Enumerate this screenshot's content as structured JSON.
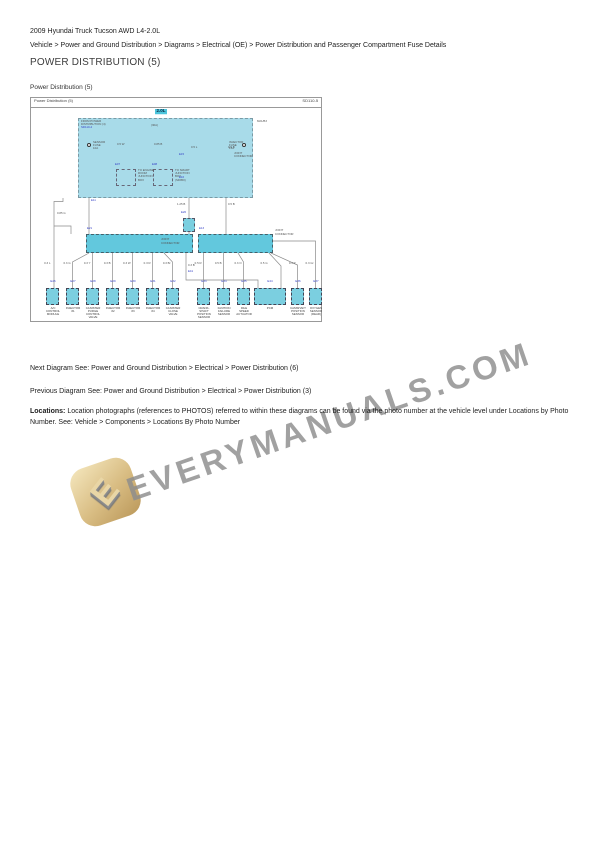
{
  "page": {
    "vehicle_title": "2009 Hyundai Truck Tucson AWD L4-2.0L",
    "breadcrumb": "Vehicle > Power and Ground Distribution > Diagrams > Electrical (OE) > Power Distribution and Passenger Compartment Fuse Details",
    "heading": "POWER DISTRIBUTION (5)",
    "diagram_caption": "Power Distribution (5)",
    "next_diagram": "Next Diagram See: Power and Ground Distribution > Electrical > Power Distribution (6)",
    "previous_diagram": "Previous Diagram See: Power and Ground Distribution > Electrical > Power Distribution (3)",
    "locations_label": "Locations:",
    "locations_text": " Location photographs (references to PHOTOS) referred to within these diagrams can be found via the photo number at the vehicle level under Locations by Photo Number. See: Vehicle > Components > Locations By Photo Number"
  },
  "watermark": {
    "text": "EVERYMANUALS.COM",
    "logo_letter": "E"
  },
  "colors": {
    "diagram_box_fill": "#a8dbe9",
    "joint_connector_fill": "#62c8dd",
    "engine_tag_fill": "#4cc5dc",
    "blue_label": "#3540c6",
    "wire_gray": "#8a8a8a",
    "watermark_gray": "#8d8d8d",
    "logo_tan": "#d8bc82"
  },
  "diagram": {
    "title": "Power Distribution (5)",
    "code": "SD110-5",
    "engine_tag": "2.0L",
    "labels": [
      {
        "x": 50,
        "y": 22,
        "t": "FROM POWER"
      },
      {
        "x": 50,
        "y": 25.2,
        "t": "DISTRIBUTION (4)"
      },
      {
        "x": 50,
        "y": 28.4,
        "t": "SD110-4",
        "c": "b"
      },
      {
        "x": 120,
        "y": 25.5,
        "t": "(30A)"
      },
      {
        "x": 226,
        "y": 22,
        "t": "M21/B3"
      },
      {
        "x": 62,
        "y": 43,
        "t": "SENSOR"
      },
      {
        "x": 62,
        "y": 46.2,
        "t": "FUSE"
      },
      {
        "x": 62,
        "y": 49.4,
        "t": "10A"
      },
      {
        "x": 198,
        "y": 43,
        "t": "INJECTOR"
      },
      {
        "x": 198,
        "y": 46.2,
        "t": "FUSE"
      },
      {
        "x": 198,
        "y": 49.4,
        "t": "15A"
      },
      {
        "x": 86,
        "y": 45,
        "t": "0.5 W"
      },
      {
        "x": 123,
        "y": 45,
        "t": "0.85 B"
      },
      {
        "x": 84,
        "y": 65,
        "t": "E07",
        "c": "b"
      },
      {
        "x": 121,
        "y": 65,
        "t": "E08",
        "c": "b"
      },
      {
        "x": 107,
        "y": 71,
        "t": "TO ENGINE"
      },
      {
        "x": 107,
        "y": 74.2,
        "t": "ROOM"
      },
      {
        "x": 107,
        "y": 77.4,
        "t": "JUNCTION"
      },
      {
        "x": 107,
        "y": 80.6,
        "t": "BOX"
      },
      {
        "x": 144,
        "y": 71,
        "t": "TO SMART"
      },
      {
        "x": 144,
        "y": 74.2,
        "t": "JUNCTION"
      },
      {
        "x": 144,
        "y": 77.4,
        "t": "BOX"
      },
      {
        "x": 144,
        "y": 80.6,
        "t": "(SD950)"
      },
      {
        "x": 148,
        "y": 55,
        "t": "E15",
        "c": "b"
      },
      {
        "x": 148,
        "y": 77.5,
        "t": "E16",
        "c": "b"
      },
      {
        "x": 160,
        "y": 48,
        "t": "0.5 L"
      },
      {
        "x": 197,
        "y": 48,
        "t": "0.5 B"
      },
      {
        "x": 203,
        "y": 54,
        "t": "JOINT"
      },
      {
        "x": 203,
        "y": 57.2,
        "t": "CONNECTOR"
      },
      {
        "x": 60,
        "y": 101,
        "t": "E11",
        "c": "b"
      },
      {
        "x": 26,
        "y": 114,
        "t": "0.85 G"
      },
      {
        "x": 146,
        "y": 105,
        "t": "1.25 B"
      },
      {
        "x": 197,
        "y": 105,
        "t": "0.5 B"
      },
      {
        "x": 150,
        "y": 113,
        "t": "E20",
        "c": "b"
      },
      {
        "x": 56,
        "y": 129,
        "t": "E21",
        "c": "b"
      },
      {
        "x": 168,
        "y": 129,
        "t": "E13",
        "c": "b"
      },
      {
        "x": 130,
        "y": 140,
        "t": "JOINT"
      },
      {
        "x": 130,
        "y": 143.5,
        "t": "CONNECTOR"
      },
      {
        "x": 244,
        "y": 131,
        "t": "JOINT"
      },
      {
        "x": 244,
        "y": 134.5,
        "t": "CONNECTOR"
      },
      {
        "x": 157,
        "y": 166,
        "t": "0.3 B"
      },
      {
        "x": 157,
        "y": 172,
        "t": "E41",
        "c": "b"
      }
    ],
    "components": [
      {
        "cx": 21.5,
        "hx": -6.5,
        "w": 13,
        "wire": "0.3 L",
        "code": "E26",
        "caption": "A/C\nCONTROL\nMODULE"
      },
      {
        "cx": 41.5,
        "hx": -6.5,
        "w": 13,
        "wire": "0.3 G",
        "code": "E27",
        "caption": "INJECTOR\n#1"
      },
      {
        "cx": 61.5,
        "hx": -6.5,
        "w": 13,
        "wire": "0.3 Y",
        "code": "E28",
        "caption": "CANISTER\nPURGE\nCONTROL\nVALVE"
      },
      {
        "cx": 81.5,
        "hx": -6.5,
        "w": 13,
        "wire": "0.3 B",
        "code": "E29",
        "caption": "INJECTOR\n#2"
      },
      {
        "cx": 101.5,
        "hx": -6.5,
        "w": 13,
        "wire": "0.3 W",
        "code": "E30",
        "caption": "INJECTOR\n#3"
      },
      {
        "cx": 121.5,
        "hx": -6.5,
        "w": 13,
        "wire": "0.3 R",
        "code": "E31",
        "caption": "INJECTOR\n#4"
      },
      {
        "cx": 141.5,
        "hx": -6.5,
        "w": 13,
        "wire": "0.3 Br",
        "code": "E32",
        "caption": "CANISTER\nCLOSE\nVALVE"
      },
      {
        "cx": 172.5,
        "hx": -6.5,
        "w": 13,
        "wire": "0.5 R",
        "code": "E33",
        "caption": "CRANK-\nSHAFT\nPOSITION\nSENSOR"
      },
      {
        "cx": 192.5,
        "hx": -6.5,
        "w": 13,
        "wire": "0.5 B",
        "code": "E34",
        "caption": "IGNITION\nFAILURE\nSENSOR"
      },
      {
        "cx": 212.5,
        "hx": -6.5,
        "w": 13,
        "wire": "0.3 O",
        "code": "E35",
        "caption": "IDLE\nSPEED\nACTUATOR"
      },
      {
        "cx": 239,
        "hx": -16,
        "w": 32,
        "wire": "0.5 G",
        "code": "E44",
        "caption": "PCM"
      },
      {
        "cx": 266.5,
        "hx": -6.5,
        "w": 13,
        "wire": "0.3 P",
        "code": "E36",
        "caption": "CAMSHAFT\nPOSITION\nSENSOR"
      },
      {
        "cx": 284.5,
        "hx": -6.5,
        "w": 13,
        "wire": "0.3 Gr",
        "code": "E37",
        "caption": "OXYGEN\nSENSOR\n(REAR)"
      }
    ]
  }
}
